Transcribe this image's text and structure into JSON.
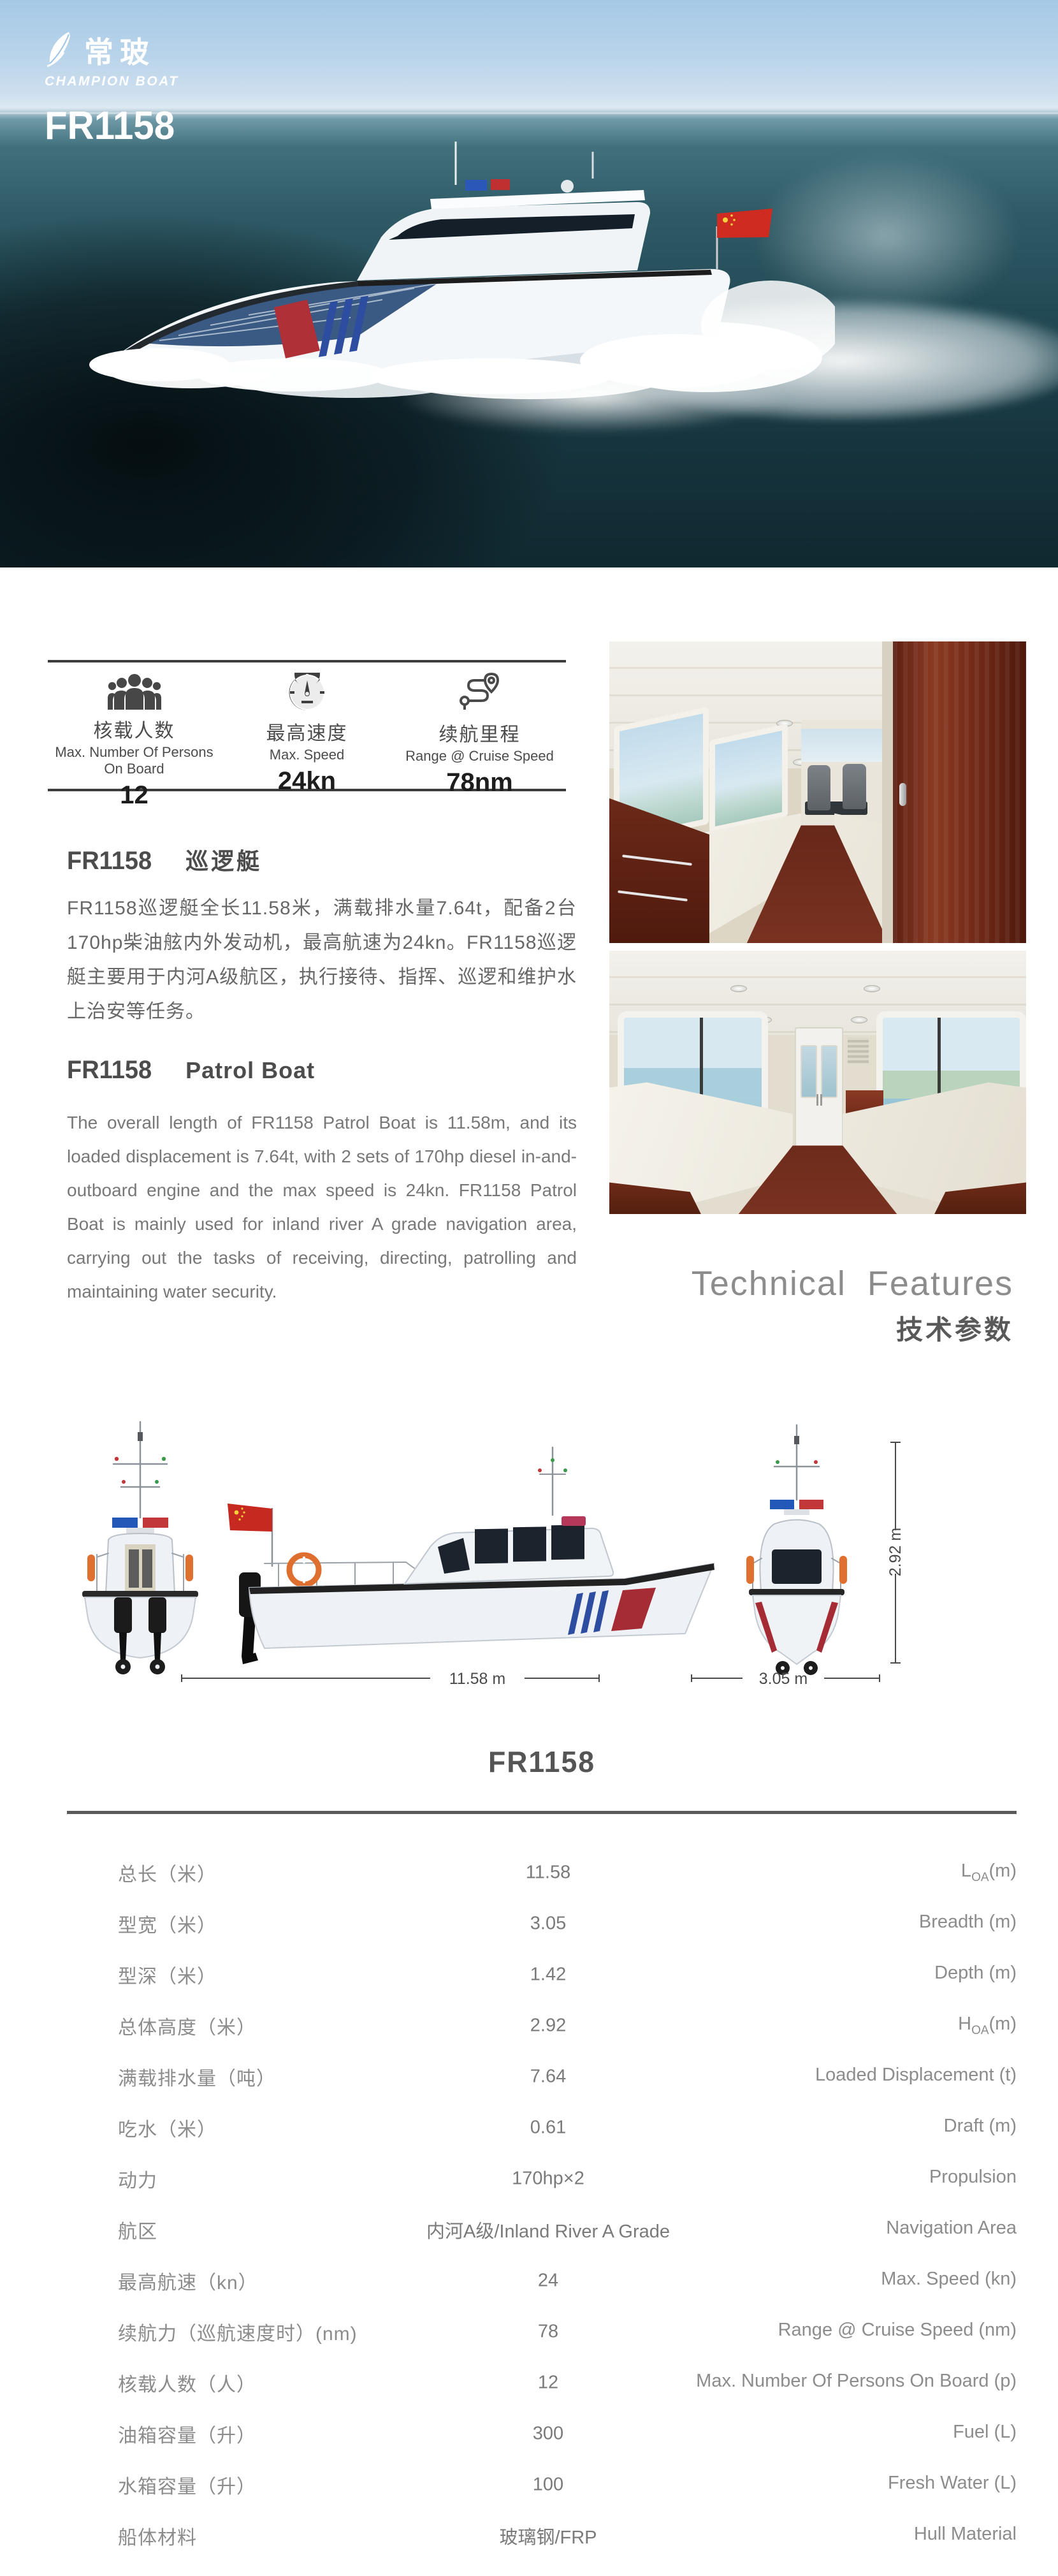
{
  "hero": {
    "brand_cn": "常玻",
    "brand_en": "CHAMPION BOAT",
    "model": "FR1158"
  },
  "quick_specs": {
    "items": [
      {
        "icon": "persons-group-icon",
        "label_cn": "核载人数",
        "label_en": "Max. Number Of Persons On Board",
        "value": "12"
      },
      {
        "icon": "speedometer-icon",
        "label_cn": "最高速度",
        "label_en": "Max. Speed",
        "value": "24kn"
      },
      {
        "icon": "route-pin-icon",
        "label_cn": "续航里程",
        "label_en": "Range @ Cruise Speed",
        "value": "78nm"
      }
    ]
  },
  "intro_cn": {
    "model": "FR1158",
    "title": "巡逻艇",
    "body": "FR1158巡逻艇全长11.58米，满载排水量7.64t，配备2台170hp柴油舷内外发动机，最高航速为24kn。FR1158巡逻艇主要用于内河A级航区，执行接待、指挥、巡逻和维护水上治安等任务。"
  },
  "intro_en": {
    "model": "FR1158",
    "title": "Patrol Boat",
    "body": "The overall length of FR1158 Patrol Boat is 11.58m, and its loaded displacement is 7.64t, with 2 sets of 170hp diesel in-and-outboard engine and the max speed is 24kn. FR1158 Patrol Boat is mainly used for inland river A grade navigation area, carrying out the tasks of receiving, directing, patrolling and maintaining water security."
  },
  "tech_heading": {
    "en": "Technical Features",
    "cn": "技术参数"
  },
  "drawings": {
    "length_label": "11.58 m",
    "beam_label": "3.05 m",
    "height_label": "2.92 m"
  },
  "spec_table": {
    "title": "FR1158",
    "rows": [
      {
        "cn": "总长（米）",
        "value": "11.58",
        "en": "L",
        "en_sub": "OA",
        "en_post": "(m)"
      },
      {
        "cn": "型宽（米）",
        "value": "3.05",
        "en": "Breadth (m)",
        "en_sub": "",
        "en_post": ""
      },
      {
        "cn": "型深（米）",
        "value": "1.42",
        "en": "Depth (m)",
        "en_sub": "",
        "en_post": ""
      },
      {
        "cn": "总体高度（米）",
        "value": "2.92",
        "en": "H",
        "en_sub": "OA",
        "en_post": "(m)"
      },
      {
        "cn": "满载排水量（吨）",
        "value": "7.64",
        "en": "Loaded Displacement (t)",
        "en_sub": "",
        "en_post": ""
      },
      {
        "cn": "吃水（米）",
        "value": "0.61",
        "en": "Draft (m)",
        "en_sub": "",
        "en_post": ""
      },
      {
        "cn": "动力",
        "value": "170hp×2",
        "en": "Propulsion",
        "en_sub": "",
        "en_post": ""
      },
      {
        "cn": "航区",
        "value": "内河A级/Inland River A Grade",
        "en": "Navigation Area",
        "en_sub": "",
        "en_post": ""
      },
      {
        "cn": "最高航速（kn）",
        "value": "24",
        "en": "Max. Speed (kn)",
        "en_sub": "",
        "en_post": ""
      },
      {
        "cn": "续航力（巡航速度时）(nm)",
        "value": "78",
        "en": "Range @ Cruise Speed (nm)",
        "en_sub": "",
        "en_post": ""
      },
      {
        "cn": "核载人数（人）",
        "value": "12",
        "en": "Max. Number Of Persons On Board (p)",
        "en_sub": "",
        "en_post": ""
      },
      {
        "cn": "油箱容量（升）",
        "value": "300",
        "en": "Fuel (L)",
        "en_sub": "",
        "en_post": ""
      },
      {
        "cn": "水箱容量（升）",
        "value": "100",
        "en": "Fresh Water (L)",
        "en_sub": "",
        "en_post": ""
      },
      {
        "cn": "船体材料",
        "value": "玻璃钢/FRP",
        "en": "Hull Material",
        "en_sub": "",
        "en_post": ""
      }
    ]
  },
  "colors": {
    "flag_red": "#c5291f",
    "stripe_red": "#a52c34",
    "stripe_blue": "#2d4da0",
    "life_ring_orange": "#e07030",
    "rule_gray": "#5a5a5a"
  }
}
